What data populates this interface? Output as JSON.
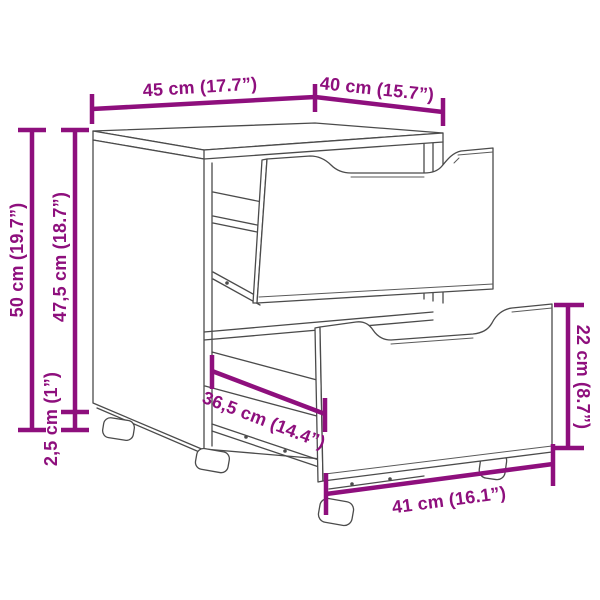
{
  "diagram": {
    "type": "furniture-dimension-diagram",
    "labels": {
      "top_width": "45 cm (17.7”)",
      "top_depth": "40 cm (15.7”)",
      "total_height": "50 cm (19.7”)",
      "body_height": "47,5 cm (18.7”)",
      "foot_height": "2,5 cm (1”)",
      "inner_depth": "36,5 cm (14.4”)",
      "drawer_front_height": "22 cm (8.7”)",
      "drawer_front_width": "41 cm (16.1”)"
    },
    "colors": {
      "dimension_accent": "#8E0F7D",
      "outline": "#4b4b4b",
      "background": "#ffffff"
    }
  }
}
